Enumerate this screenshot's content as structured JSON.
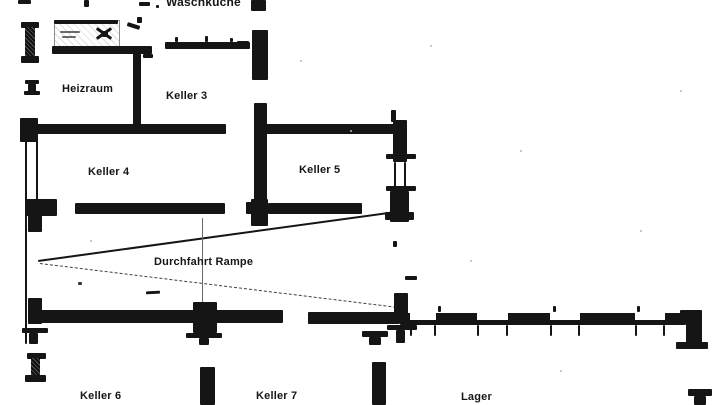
{
  "document": {
    "kind": "scanned basement floor plan",
    "language": "de",
    "paper_color": "#ffffff",
    "ink_color": "#1a1a1a"
  },
  "rooms": {
    "waschkueche": {
      "label": "Waschküche"
    },
    "heizraum": {
      "label": "Heizraum"
    },
    "keller3": {
      "label": "Keller 3"
    },
    "keller4": {
      "label": "Keller 4"
    },
    "keller5": {
      "label": "Keller 5"
    },
    "durchfahrt_rampe": {
      "label": "Durchfahrt Rampe"
    },
    "keller6": {
      "label": "Keller 6"
    },
    "keller7": {
      "label": "Keller 7"
    },
    "lager": {
      "label": "Lager"
    }
  }
}
